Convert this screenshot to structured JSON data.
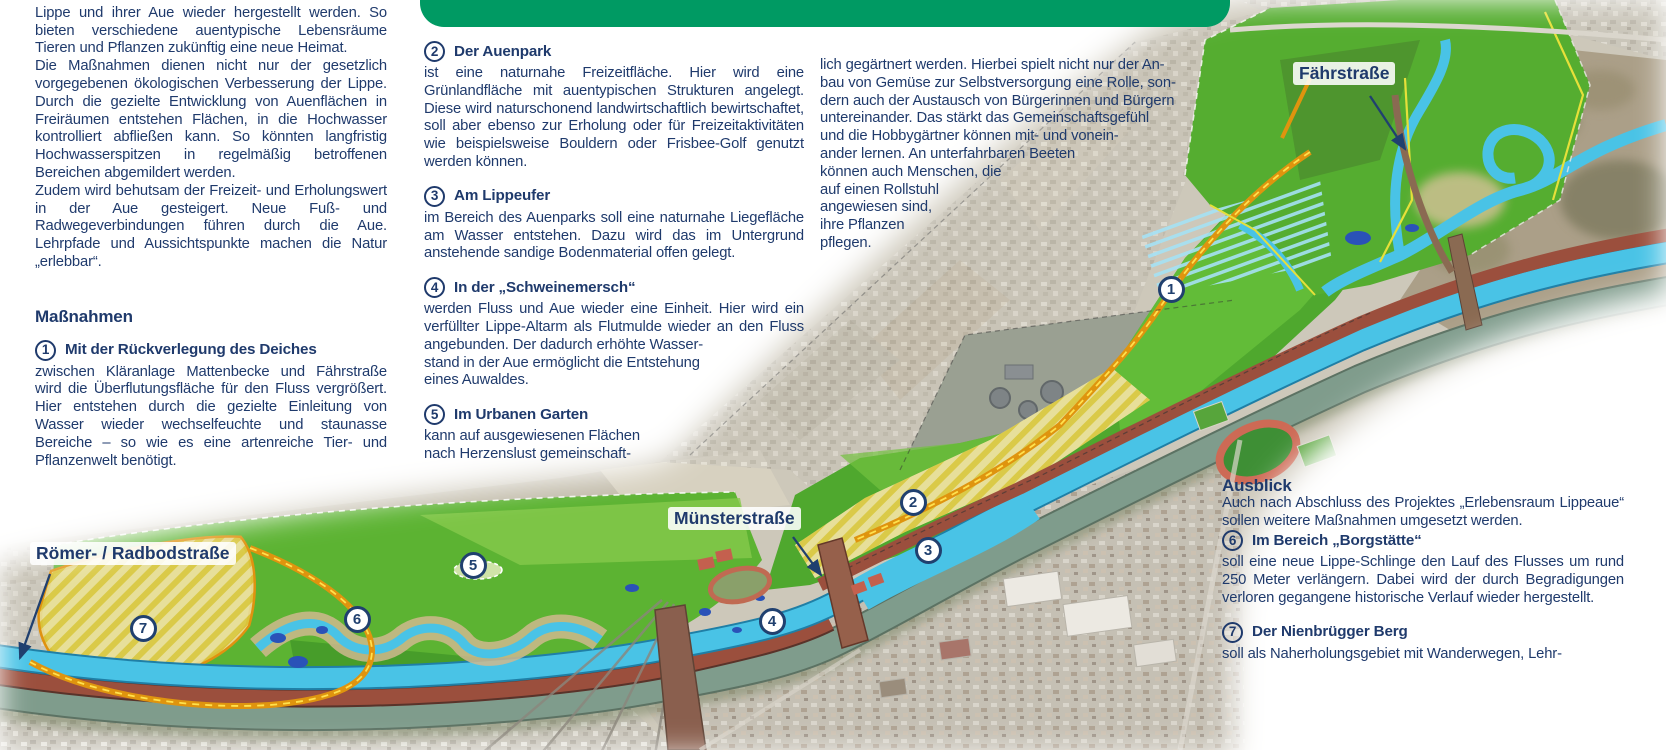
{
  "intro": {
    "clipped_first_line": "liche Maßnahmen soll der natürliche Charakter der",
    "p1": "Lippe und ihrer Aue wieder hergestellt werden. So bieten verschiedene auentypische Lebensräume Tieren und Pflanzen zukünftig eine neue Heimat.",
    "p2": "Die Maßnahmen dienen nicht nur der gesetzlich vorgegebenen ökologischen Verbesserung der Lippe. Durch die gezielte Entwicklung von Auenflächen in Freiräumen entstehen Flächen, in die Hochwasser kontrolliert abfließen kann. So könnten langfristig Hochwasserspitzen in regelmäßig betroffenen Bereichen abgemildert werden.",
    "p3": "Zudem wird behutsam der Freizeit- und Erholungswert in der Aue gesteigert. Neue Fuß- und Radwegeverbindungen führen durch die Aue. Lehrpfade und Aussichtspunkte machen die Natur „erlebbar“."
  },
  "massnahmen": {
    "heading": "Maßnahmen",
    "items": [
      {
        "num": "1",
        "title": "Mit der Rückverlegung des Deiches",
        "body": "zwischen Kläranlage Mattenbecke und Fährstraße wird die Überflutungsfläche für den Fluss vergrößert. Hier entstehen durch die gezielte Einleitung von Wasser wieder wechselfeuchte und staunasse Bereiche – so wie es eine artenreiche Tier- und Pflanzenwelt benötigt."
      },
      {
        "num": "2",
        "title": "Der Auenpark",
        "body": "ist eine naturnahe Freizeitfläche. Hier wird eine Grünlandfläche mit auentypischen Strukturen angelegt. Diese wird naturschonend landwirtschaftlich bewirtschaftet, soll aber ebenso zur Erholung oder für Freizeitaktivitäten wie beispielsweise Bouldern oder Frisbee-Golf genutzt werden können."
      },
      {
        "num": "3",
        "title": "Am Lippeufer",
        "body": "im Bereich des Auenparks soll eine naturnahe Liegefläche am Wasser entstehen. Dazu wird das im Untergrund anstehende sandige Bodenmaterial offen gelegt."
      },
      {
        "num": "4",
        "title": "In der „Schweinemersch“",
        "body": "werden Fluss und Aue wieder eine Einheit. Hier wird ein verfüllter Lippe-Altarm als Flutmulde wieder an den Fluss angebunden. Der dadurch erhöhte Wasser-\nstand in der Aue ermöglicht die Entstehung\neines Auwaldes."
      },
      {
        "num": "5",
        "title": "Im Urbanen Garten",
        "body": "kann auf ausgewiesenen Flächen\nnach Herzenslust gemeinschaft-"
      }
    ]
  },
  "continuation": {
    "text": "lich gegärtnert werden. Hierbei spielt nicht nur der An-\nbau von Gemüse zur Selbstversorgung eine Rolle, son-\ndern auch der Austausch von Bürgerinnen und Bürgern\nuntereinander. Das stärkt das Gemeinschaftsgefühl\nund die Hobbygärtner können mit- und vonein-\nander lernen. An unterfahrbaren Beeten\nkönnen auch Menschen, die\nauf einen Rollstuhl\nangewiesen sind,\nihre Pflanzen\npflegen."
  },
  "ausblick": {
    "heading": "Ausblick",
    "intro": "Auch nach Abschluss des Projektes „Erlebensraum Lippeaue“ sollen weitere Maßnahmen umgesetzt werden.",
    "items": [
      {
        "num": "6",
        "title": "Im Bereich „Borgstätte“",
        "body": "soll eine neue Lippe-Schlinge den Lauf des Flusses um rund 250 Meter verlängern. Dabei wird der durch Begradigungen verloren gegangene historische Verlauf wieder hergestellt."
      },
      {
        "num": "7",
        "title": "Der Nienbrügger Berg",
        "body": "soll als Naherholungsgebiet mit Wanderwegen, Lehr-"
      }
    ]
  },
  "map": {
    "labels": [
      {
        "id": "faehrstrasse",
        "text": "Fährstraße",
        "x": 1293,
        "y": 62,
        "arrow": {
          "x1": 1370,
          "y1": 96,
          "x2": 1405,
          "y2": 149
        }
      },
      {
        "id": "muensterstrasse",
        "text": "Münsterstraße",
        "x": 668,
        "y": 507,
        "arrow": {
          "x1": 793,
          "y1": 537,
          "x2": 821,
          "y2": 575
        }
      },
      {
        "id": "roemer-radbodstrasse",
        "text": "Römer- / Radbodstraße",
        "x": 30,
        "y": 542,
        "arrow": {
          "x1": 50,
          "y1": 574,
          "x2": 20,
          "y2": 658
        }
      }
    ],
    "markers": [
      {
        "n": "1",
        "x": 1171,
        "y": 289
      },
      {
        "n": "2",
        "x": 913,
        "y": 502
      },
      {
        "n": "3",
        "x": 928,
        "y": 550
      },
      {
        "n": "4",
        "x": 772,
        "y": 621
      },
      {
        "n": "5",
        "x": 473,
        "y": 565
      },
      {
        "n": "6",
        "x": 357,
        "y": 619
      },
      {
        "n": "7",
        "x": 143,
        "y": 628
      }
    ],
    "colors": {
      "accent_green": "#009a63",
      "text_navy": "#1f3a6c",
      "project_green": "#55ad30",
      "river_cyan": "#49c3e6",
      "dike_orange": "#df940e",
      "field_yellow": "#d6c52f"
    }
  }
}
